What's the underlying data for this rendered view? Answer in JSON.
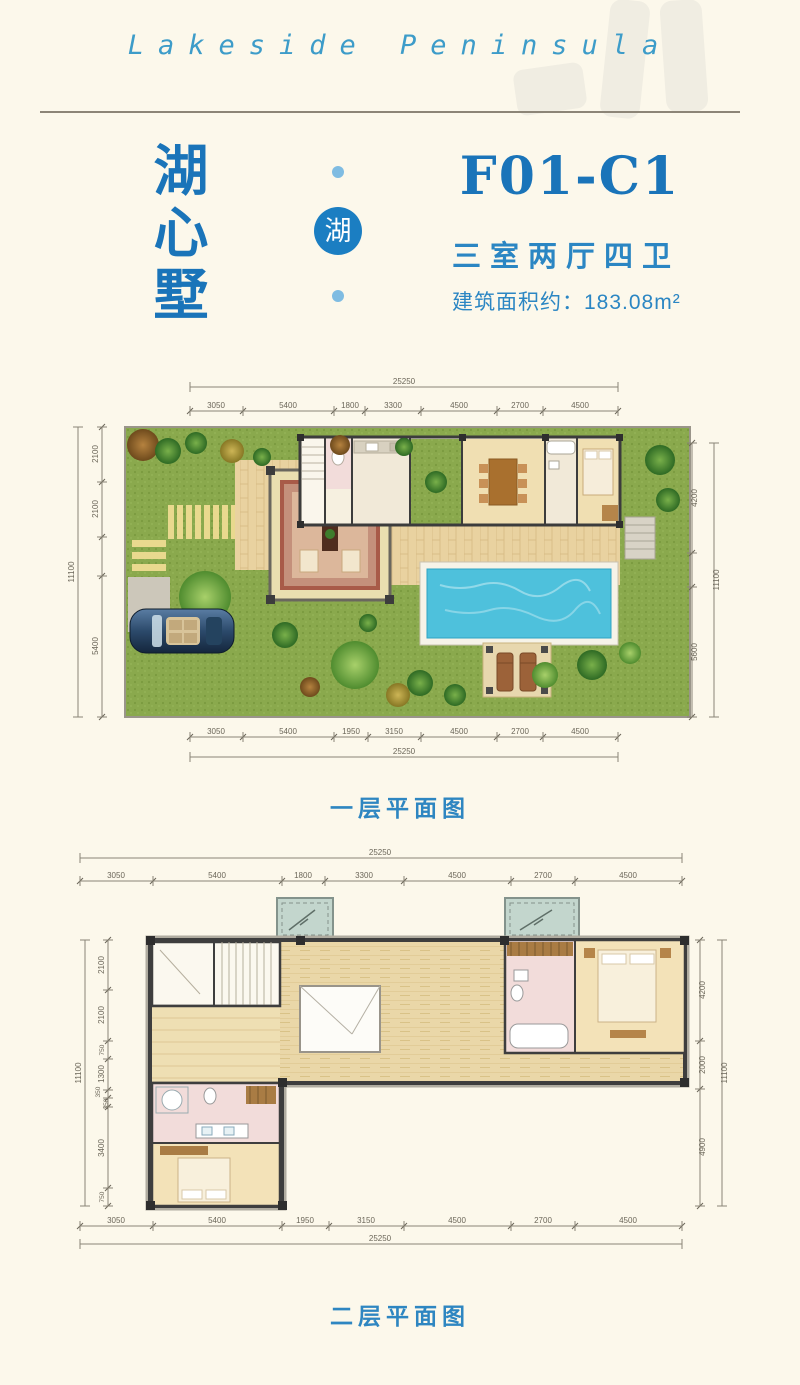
{
  "header": {
    "brand": "Lakeside Peninsula"
  },
  "title_block": {
    "estate_name": [
      "湖",
      "心",
      "墅"
    ],
    "badge_char": "湖",
    "unit_code": "F01-C1",
    "layout": "三室两厅四卫",
    "area": "建筑面积约：183.08m²"
  },
  "floor1": {
    "caption": "一层平面图",
    "dims": {
      "top": {
        "total": "25250",
        "segments": [
          "3050",
          "5400",
          "1800",
          "3300",
          "4500",
          "2700",
          "4500"
        ]
      },
      "bottom": {
        "total": "25250",
        "segments": [
          "3050",
          "5400",
          "1950",
          "3150",
          "4500",
          "2700",
          "4500"
        ]
      },
      "left": {
        "total": "11100",
        "segments": [
          "2100",
          "2100",
          "5400"
        ]
      },
      "right": {
        "total": "11100",
        "segments": [
          "4200",
          "5600"
        ]
      }
    }
  },
  "floor2": {
    "caption": "二层平面图",
    "dims": {
      "top": {
        "total": "25250",
        "segments": [
          "3050",
          "5400",
          "1800",
          "3300",
          "4500",
          "2700",
          "4500"
        ]
      },
      "bottom": {
        "total": "25250",
        "segments": [
          "3050",
          "5400",
          "1950",
          "3150",
          "4500",
          "2700",
          "4500"
        ]
      },
      "left": {
        "total": "11100",
        "segments": [
          "2100",
          "2100",
          "750",
          "1300",
          "350",
          "350",
          "3400",
          "750"
        ]
      },
      "right": {
        "total": "11100",
        "segments": [
          "4200",
          "2000",
          "4900"
        ]
      }
    }
  },
  "colors": {
    "background": "#fcf8eb",
    "accent_blue": "#1a74b9",
    "text_blue": "#2b86c3",
    "brand_blue": "#3d9cc9",
    "grass": "#8aa94d",
    "wood_deck": "#e9d2a0",
    "pool_water": "#4ec1dc",
    "carpet": "#c4907b",
    "wall": "#3c3c3c",
    "bath_tile_pink": "#f2dcda",
    "dim_text": "#6b6659"
  }
}
